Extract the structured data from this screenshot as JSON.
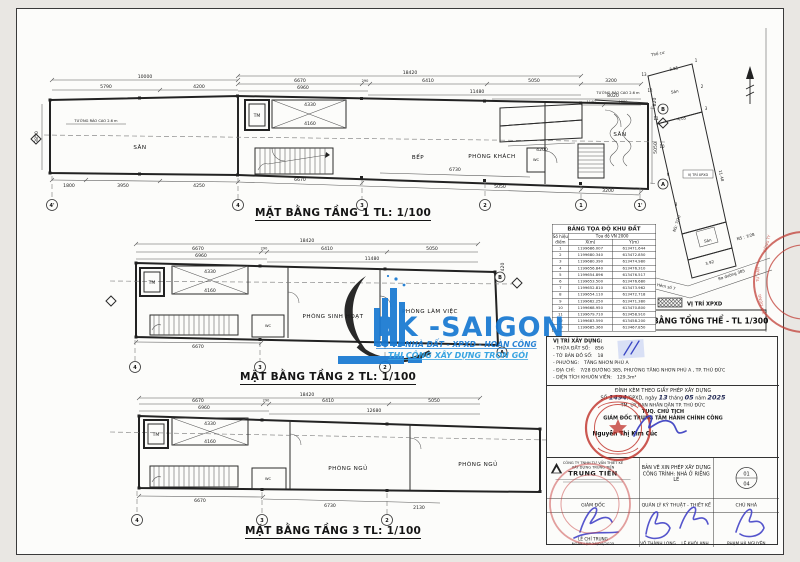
{
  "watermark": {
    "name": "BK -SAIGON",
    "line1": "ĐO VẼ NHÀ ĐẤT - XPXD - HOÀN CÔNG",
    "line2": "THI CÔNG XÂY DỰNG TRỌN GÓI"
  },
  "plans": {
    "floor1": {
      "title": "MẶT BẰNG TẦNG 1 TL: 1/100",
      "rooms": {
        "san_left": "SÂN",
        "tm": "TM",
        "bep": "BẾP",
        "phong_khach": "PHÒNG KHÁCH",
        "san_right": "SÂN",
        "wc": "WC"
      },
      "fence_left": "TƯỜNG RÀO CAO 2.6 m",
      "fence_right": "TƯỜNG RÀO CAO 2.6 m",
      "dims": {
        "w18420": "18420",
        "w10000": "10000",
        "w5790": "5790",
        "w4200": "4200",
        "w6670": "6670",
        "w290": "290",
        "w6410": "6410",
        "w5050": "5050",
        "w3200": "3200",
        "w6960": "6960",
        "w11480": "11480",
        "w8020": "8020",
        "w1140": "1140",
        "w1880": "1880",
        "i4330": "4330",
        "i4160": "4160",
        "i4200": "4200",
        "b1800": "1800",
        "b3950": "3950",
        "b4250": "4250",
        "b6670": "6670",
        "b6730": "6730",
        "b5050": "5050",
        "b3200": "3200",
        "r820": "820",
        "r5050": "5050",
        "l3850": "3850"
      },
      "grids": {
        "g4p": "4'",
        "g4": "4",
        "g3": "3",
        "g2": "2",
        "g1": "1",
        "g1p": "1'",
        "gB": "B",
        "gA": "A"
      }
    },
    "floor2": {
      "title": "MẶT BẰNG TẦNG 2 TL: 1/100",
      "rooms": {
        "tm": "TM",
        "sinh_hoat": "PHÒNG SINH HOẠT",
        "lam_viec": "PHÒNG LÀM VIỆC",
        "wc": "WC"
      },
      "dims": {
        "w18420": "18420",
        "w6670": "6670",
        "w290": "290",
        "w6410": "6410",
        "w5050": "5050",
        "w6960": "6960",
        "w11480": "11480",
        "i4330": "4330",
        "i4160": "4160",
        "r420": "420",
        "b6670": "6670"
      },
      "grids": {
        "g4": "4",
        "g3": "3",
        "g2": "2",
        "gB": "B",
        "gA": "A"
      }
    },
    "floor3": {
      "title": "MẶT BẰNG TẦNG 3 TL: 1/100",
      "rooms": {
        "tm": "TM",
        "wc": "WC",
        "ngu1": "PHÒNG NGỦ",
        "ngu2": "PHÒNG NGỦ"
      },
      "dims": {
        "w18420": "18420",
        "w6670": "6670",
        "w290": "290",
        "w6410": "6410",
        "w5050": "5050",
        "w6960": "6960",
        "w12680": "12680",
        "i4330": "4330",
        "i4160": "4160",
        "b6670": "6670",
        "b6730": "6730",
        "b2130": "2130"
      },
      "grids": {
        "g4": "4",
        "g3": "3",
        "g2": "2"
      }
    }
  },
  "site_plan": {
    "title": "MẶT BẰNG TỔNG THỂ - TL 1/300",
    "legend": "VỊ TRÍ XPXD",
    "labels": {
      "tho_cu": "Thổ cư",
      "san_top": "Sân",
      "san_mid": "Sân",
      "ns1": "NS: 7/20",
      "ns2": "NS : 7/28",
      "hem": "Hẻm số 7",
      "ra_duong": "Ra đường 385",
      "vi_tri": "VỊ TRÍ XPXD"
    },
    "lengths": {
      "e385": "3.85",
      "e405": "4.05",
      "e392": "3.92",
      "e1148": "11.48"
    },
    "points": {
      "p1": "1",
      "p2": "2",
      "p3": "3",
      "p8": "8",
      "p9": "9",
      "p10": "10",
      "p11": "11",
      "p12": "12",
      "p13": "13"
    }
  },
  "coord_table": {
    "title": "BẢNG TỌA ĐỘ KHU ĐẤT",
    "col_point": "Số hiệu điểm",
    "col_group": "Tọa độ VN 2000",
    "col_x": "X(m)",
    "col_y": "Y(m)",
    "rows": [
      [
        "1",
        "1199686.007",
        "613471.644"
      ],
      [
        "2",
        "1199680.340",
        "613472.850"
      ],
      [
        "3",
        "1199680.390",
        "613474.980"
      ],
      [
        "4",
        "1199656.840",
        "613476.310"
      ],
      [
        "5",
        "1199654.896",
        "613476.517"
      ],
      [
        "6",
        "1199653.500",
        "613476.680"
      ],
      [
        "7",
        "1199652.810",
        "613473.962"
      ],
      [
        "8",
        "1199654.110",
        "613472.718"
      ],
      [
        "9",
        "1199662.250",
        "613471.380"
      ],
      [
        "10",
        "1199668.950",
        "613470.800"
      ],
      [
        "11",
        "1199679.710",
        "613458.910"
      ],
      [
        "12",
        "1199683.590",
        "613458.200"
      ],
      [
        "13",
        "1199685.360",
        "613467.850"
      ]
    ]
  },
  "location": {
    "heading": "VỊ TRÍ XÂY DỰNG:",
    "items": [
      {
        "label": "- THỬA ĐẤT SỐ:",
        "value": "856"
      },
      {
        "label": "- TỜ BẢN ĐỒ SỐ:",
        "value": "18"
      },
      {
        "label": "- PHƯỜNG:",
        "value": "TĂNG NHƠN PHÚ A"
      },
      {
        "label": "- ĐỊA CHỈ:",
        "value": "7/28 ĐƯỜNG 385, PHƯỜNG TĂNG NHƠN PHÚ A , TP. THỦ ĐỨC"
      },
      {
        "label": "- DIỆN TÍCH KHUÔN VIÊN:",
        "value": "129.3m²"
      }
    ]
  },
  "permit": {
    "line1": "ĐÍNH KÈM THEO GIẤY PHÉP XÂY DỰNG",
    "so": "SỐ",
    "number": "1494",
    "mid1": "/GPXD, ngày",
    "day": "13",
    "mid2": "tháng",
    "month": "05",
    "mid3": "năm",
    "year": "2025",
    "line3": "TM. ỦY BAN NHÂN DÂN TP. THỦ ĐỨC",
    "line4": "TUQ. CHỦ TỊCH",
    "line5": "GIÁM ĐỐC TRUNG TÂM HÀNH CHÍNH CÔNG",
    "signer": "Nguyễn Thị Kim Cúc"
  },
  "title_block": {
    "company_line1": "CÔNG TY TNHH TƯ VẤN THIẾT KẾ",
    "company_line2": "XÂY DỰNG TRUNG TIẾN",
    "company_name": "TRUNG TIẾN",
    "role_director": "GIÁM ĐỐC",
    "doc_line1": "BẢN VẼ XIN PHÉP XÂY DỰNG",
    "doc_line2": "CÔNG TRÌNH: NHÀ Ở RIÊNG LẺ",
    "role_tech": "QUẢN LÝ KỸ THUẬT - THIẾT KẾ",
    "role_owner": "CHỦ NHÀ",
    "sheet_no": "01",
    "sheet_total": "04",
    "name_director": "LÊ CHÍ TRUNG",
    "date_created": "NGÀY LẬP 26/04/2025",
    "name_tech1": "VÕ THÀNH LONG",
    "name_tech2": "LÊ KHÔI ANH",
    "name_owner": "PHẠM HÀ NGUYÊN"
  },
  "edge_stamp": {
    "f1": "CÔNG TY",
    "f2": "TƯ VẤN",
    "f3": "XÂY DỰNG"
  }
}
